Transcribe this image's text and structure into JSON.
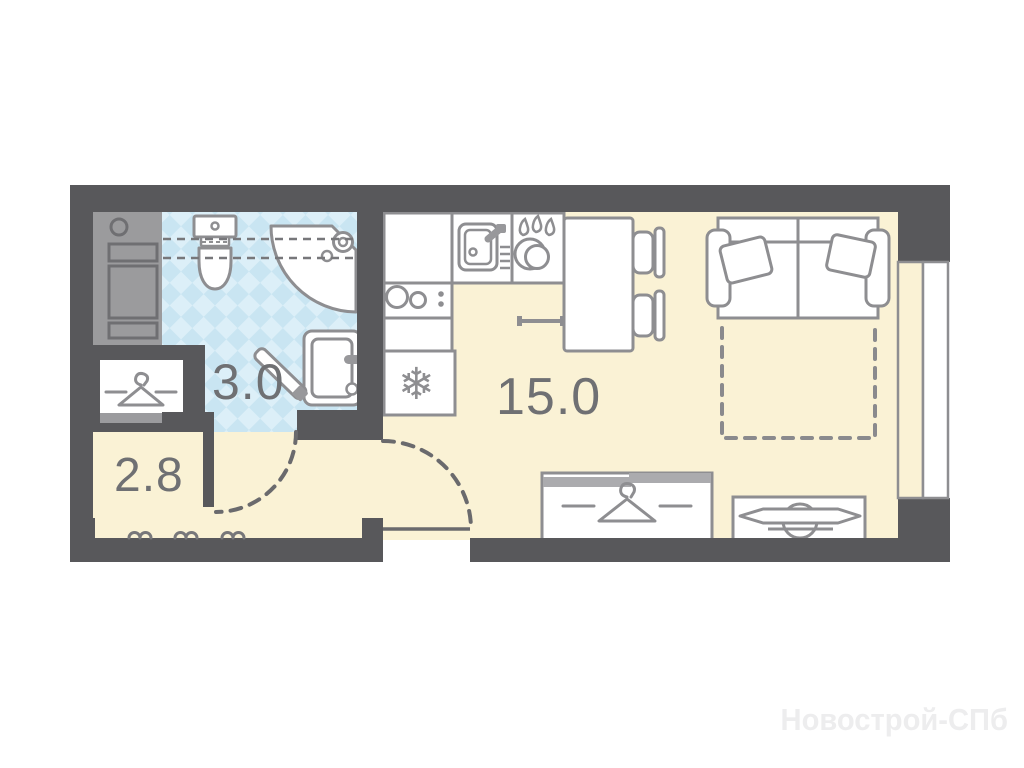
{
  "floorplan": {
    "rooms": {
      "bathroom": {
        "label": "3.0"
      },
      "living_kitchen": {
        "label": "15.0"
      },
      "hallway": {
        "label": "2.8"
      }
    },
    "watermark": "Новострой-СПб",
    "icons": {
      "snowflake": "❄"
    },
    "colors": {
      "wall": "#58585b",
      "shaft": "#9b9b9d",
      "floor": "#faf2d5",
      "bathroom_tile": "#c9e5f2",
      "bathroom_tile_light": "#dceff8",
      "furniture_outline": "#8e8e91",
      "label_text": "#6f7073",
      "door_swing": "#6a6a6d"
    }
  }
}
